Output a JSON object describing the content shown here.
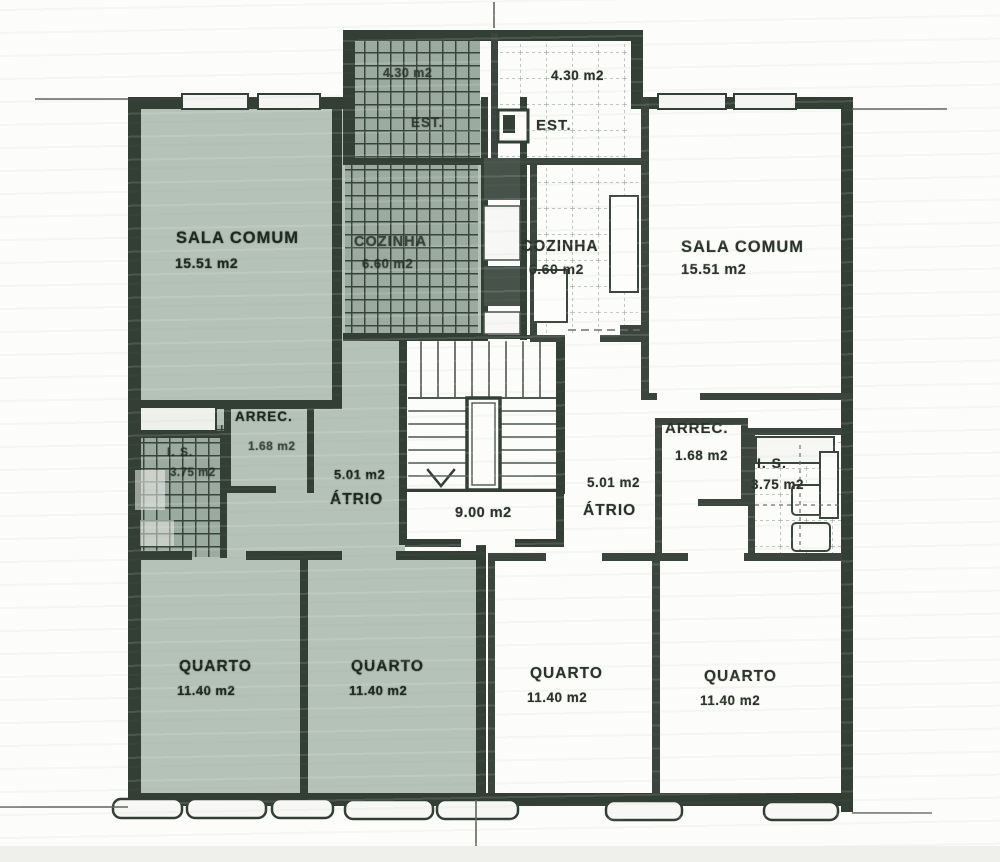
{
  "rooms": {
    "left_est": {
      "name": "EST.",
      "area": "4.30 m2"
    },
    "right_est": {
      "name": "EST.",
      "area": "4.30 m2"
    },
    "left_sala_comum": {
      "name": "SALA COMUM",
      "area": "15.51 m2"
    },
    "right_sala_comum": {
      "name": "SALA COMUM",
      "area": "15.51 m2"
    },
    "left_cozinha": {
      "name": "COZINHA",
      "area": "6.60 m2"
    },
    "right_cozinha": {
      "name": "COZINHA",
      "area": "6.60 m2"
    },
    "left_arrec": {
      "name": "ARREC.",
      "area": "1.68 m2"
    },
    "right_arrec": {
      "name": "ARREC.",
      "area": "1.68 m2"
    },
    "left_is": {
      "name": "I. S.",
      "area": "3.75 m2"
    },
    "right_is": {
      "name": "I. S.",
      "area": "3.75 m2"
    },
    "left_atrio": {
      "name": "ÁTRIO",
      "area": "5.01 m2"
    },
    "right_atrio": {
      "name": "ÁTRIO",
      "area": "5.01 m2"
    },
    "stair_lobby": {
      "area": "9.00 m2"
    },
    "quarto_1": {
      "name": "QUARTO",
      "area": "11.40 m2"
    },
    "quarto_2": {
      "name": "QUARTO",
      "area": "11.40 m2"
    },
    "quarto_3": {
      "name": "QUARTO",
      "area": "11.40 m2"
    },
    "quarto_4": {
      "name": "QUARTO",
      "area": "11.40 m2"
    }
  },
  "colors": {
    "highlight_tint": "#b5c2b8",
    "hatch_background": "#9cab9f",
    "hatch_line": "#37443a",
    "wall": "#333e35",
    "paper": "#fcfcfa"
  }
}
